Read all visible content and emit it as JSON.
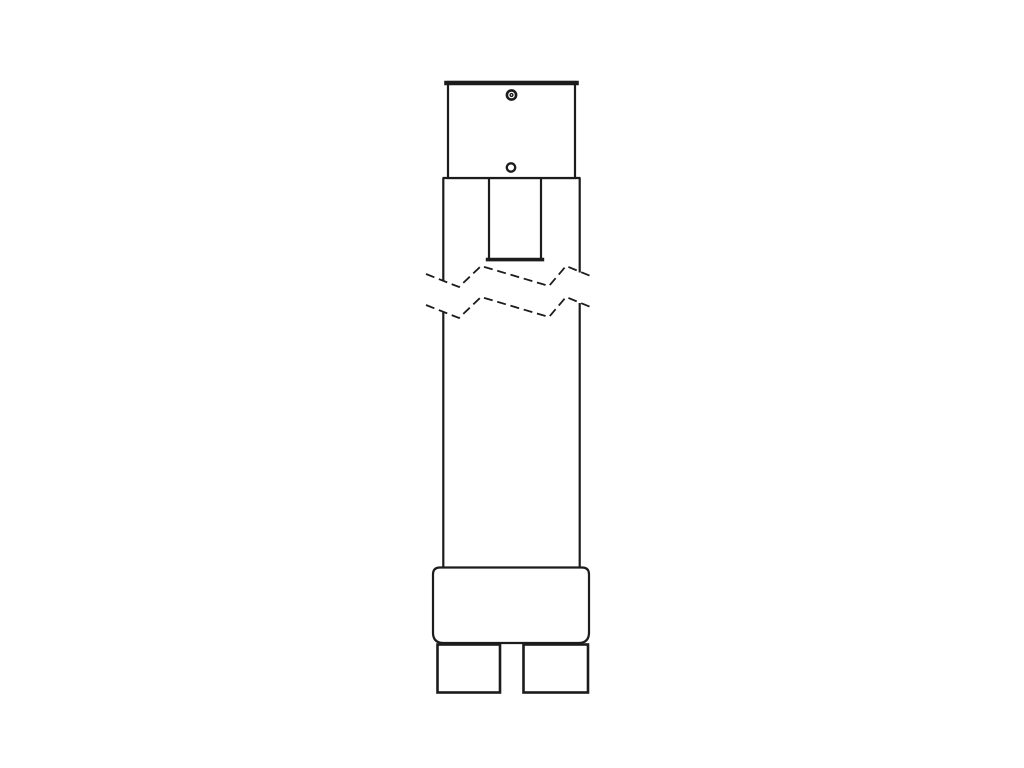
{
  "canvas": {
    "width": 1024,
    "height": 768,
    "background": "#ffffff"
  },
  "style": {
    "line_color": "#1c1c1c",
    "fill_color": "#ffffff"
  },
  "diagram": {
    "type": "technical-line-drawing",
    "text_labels": [],
    "parts": [
      {
        "name": "top-cap-plate",
        "glyph": "rectangle-with-bold-top-edge"
      },
      {
        "name": "screw-head",
        "glyph": "concentric-circles"
      },
      {
        "name": "pilot-hole",
        "glyph": "small-circle"
      },
      {
        "name": "upper-housing",
        "glyph": "rectangle"
      },
      {
        "name": "center-slot",
        "glyph": "open-slot-thick-bottom"
      },
      {
        "name": "break-line-upper",
        "glyph": "dashed-zigzag"
      },
      {
        "name": "break-line-lower",
        "glyph": "dashed-zigzag"
      },
      {
        "name": "shaft",
        "glyph": "long-broken-rectangle"
      },
      {
        "name": "base-collar",
        "glyph": "rounded-rectangle"
      },
      {
        "name": "left-foot",
        "glyph": "rectangle"
      },
      {
        "name": "right-foot",
        "glyph": "rectangle"
      }
    ]
  }
}
